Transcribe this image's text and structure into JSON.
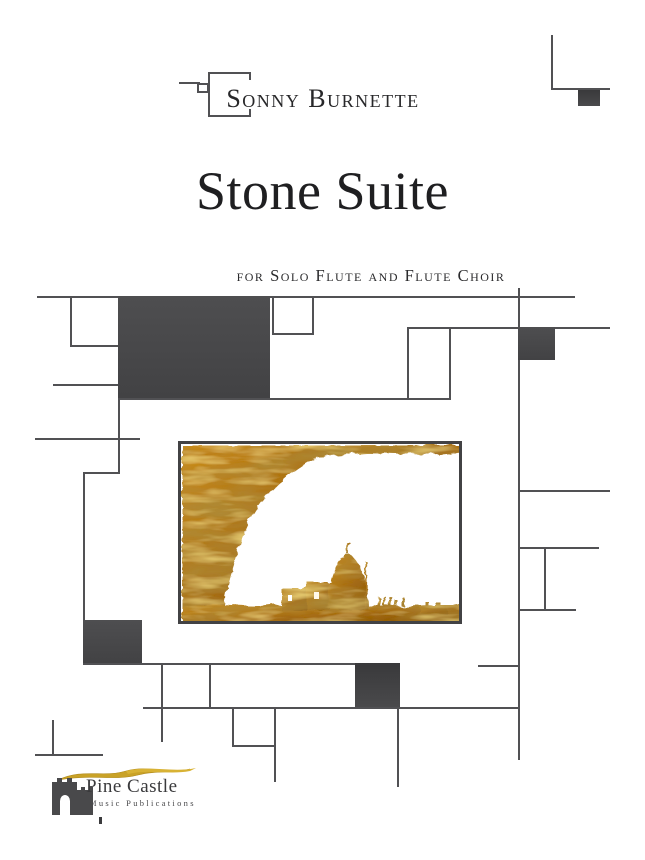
{
  "author": {
    "name": "Sonny Burnette"
  },
  "title": {
    "main": "Stone Suite",
    "subtitle": "for Solo Flute and Flute Choir"
  },
  "publisher": {
    "name": "Pine Castle",
    "tagline": "Music Publications"
  },
  "artwork": {
    "description": "golden textured painting: rock arch framing white sky over domed-city silhouette"
  },
  "palette": {
    "line": "#515154",
    "panel": "#49494b",
    "panel_dark": "#3b3b3d",
    "frame": "#424244",
    "text_dark": "#28282a",
    "gold": "#b77f1d",
    "gold_dark": "#7c4e0c",
    "gold_light": "#e6bc3f",
    "logo_gold": "#c9a227"
  }
}
